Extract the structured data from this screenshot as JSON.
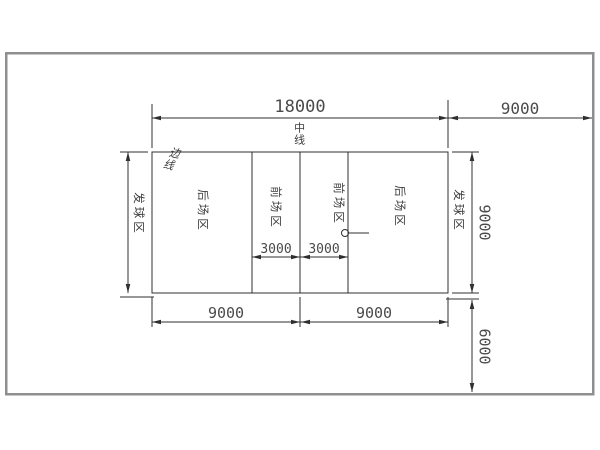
{
  "drawing": {
    "title": "volleyball-court-plan",
    "dimensions": {
      "court_length": "18000",
      "side_zone_width": "9000",
      "half_court_left": "9000",
      "half_court_right": "9000",
      "attack_zone_left": "3000",
      "attack_zone_right": "3000",
      "court_width": "9000",
      "free_zone_depth": "6000"
    },
    "labels": {
      "center_line": "中线",
      "side_line": "边线",
      "back_zone_left": "后场区",
      "front_zone_left": "前场区",
      "front_zone_right": "前场区",
      "back_zone_right": "后场区",
      "service_zone_left": "发球区",
      "service_zone_right": "发球区"
    },
    "colors": {
      "line": "#2f2f2f",
      "frame": "#8f8f8f",
      "text": "#4a4a4a",
      "background": "#ffffff"
    }
  }
}
